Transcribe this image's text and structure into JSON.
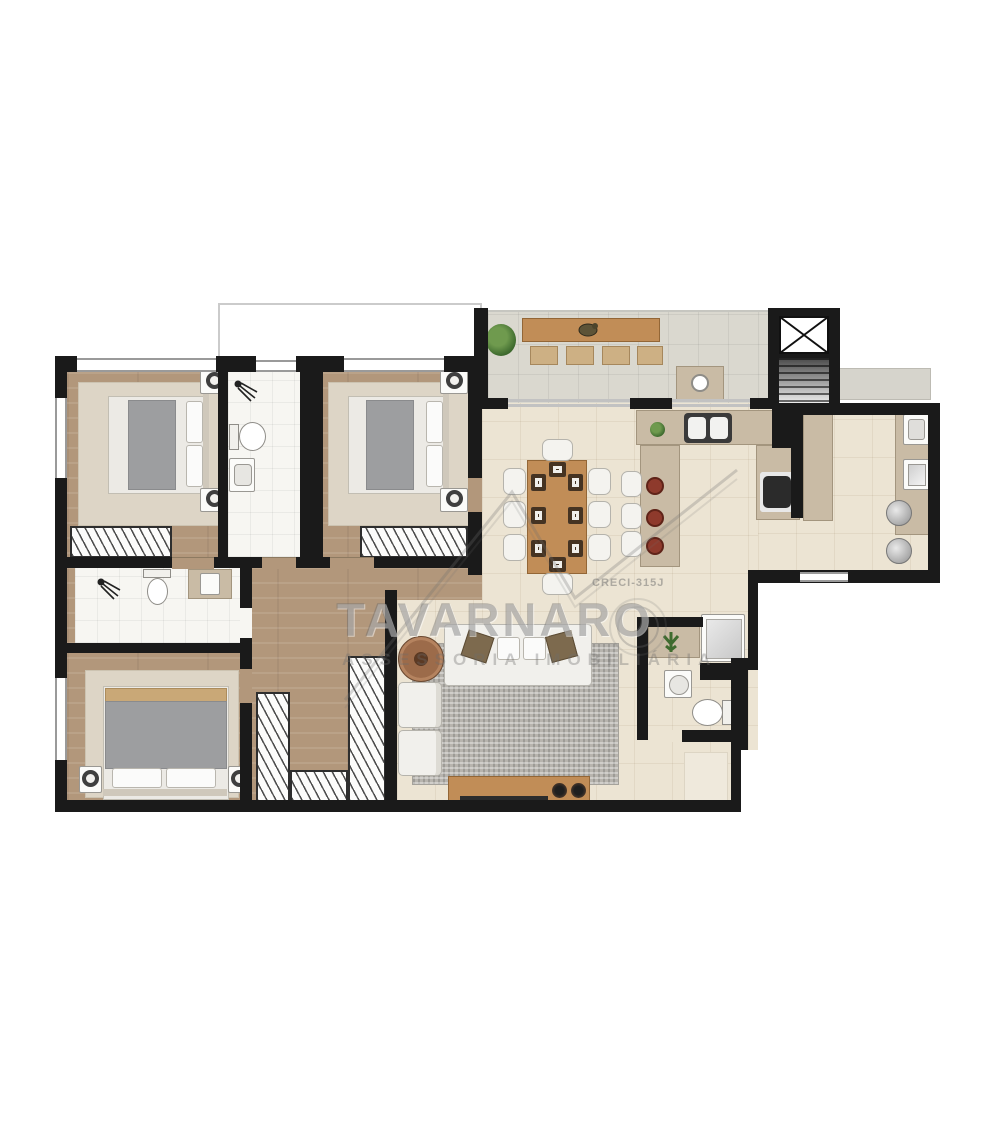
{
  "watermark": {
    "title": "TAVARNARO",
    "tagline": "ASSESSORIA IMOBILIÁRIA",
    "license": "CRECI-315J"
  },
  "palette": {
    "wall": "#1a1a1a",
    "wood_floor": "#b2977b",
    "social_floor": "#ece4d3",
    "terrace_floor": "#dad8cf",
    "counter": "#c9bba5",
    "furniture_wood": "#c18d57",
    "bed_blanket": "#9d9ea0",
    "bedroom_rug": "#ddd5c6",
    "living_rug": "#b7b4ae",
    "stool_red": "#8e3a2c",
    "plant_green": "#4e7a3a",
    "watermark_gray": "#8f8f8f"
  }
}
